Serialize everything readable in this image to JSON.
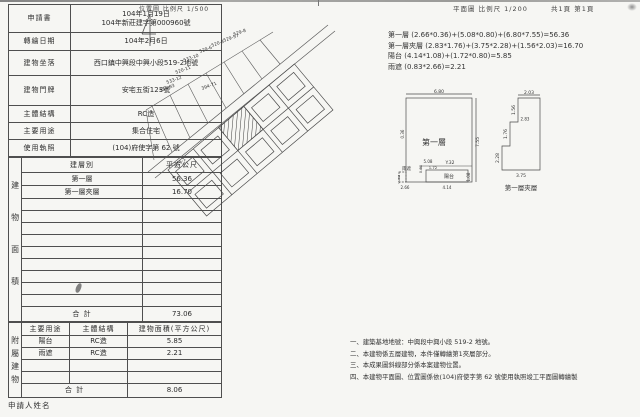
{
  "header": {
    "left_scale": "位置圖 比例尺 1/500",
    "right_scale": "平面圖 比例尺 1/200",
    "page_info": "共1頁 第1頁"
  },
  "info_table": {
    "rows": [
      {
        "label": "申請書",
        "value": "104年1月19日\n104年新莊建字第000960號"
      },
      {
        "label": "轉繪日期",
        "value": "104年2月6日"
      },
      {
        "label": "建物坐落",
        "value": "西口鎮中興段中興小段519-2地號"
      },
      {
        "label": "建物門牌",
        "value": "安宅五街123號"
      },
      {
        "label": "主體結構",
        "value": "RC造"
      },
      {
        "label": "主要用途",
        "value": "集合住宅"
      },
      {
        "label": "使用執照",
        "value": "(104)府使字第 62 號"
      }
    ]
  },
  "area_table": {
    "side_label": "建物面積",
    "header": [
      "建層別",
      "平方公尺"
    ],
    "rows": [
      [
        "第一層",
        "56.36"
      ],
      [
        "第一層夾層",
        "16.70"
      ]
    ],
    "total_label": "合  計",
    "total": "73.06"
  },
  "annex_table": {
    "side_label": "附屬建物",
    "header": [
      "主要用途",
      "主體結構",
      "建物面積(平方公尺)"
    ],
    "rows": [
      [
        "陽台",
        "RC造",
        "5.85"
      ],
      [
        "雨遮",
        "RC造",
        "2.21"
      ]
    ],
    "total_label": "合  計",
    "total": "8.06"
  },
  "applicant_label": "申請人姓名",
  "calc": {
    "lines": [
      "第一層 (2.66*0.36)+(5.08*0.80)+(6.80*7.55)=56.36",
      "第一層夾層 (2.83*1.76)+(3.75*2.28)+(1.56*2.03)=16.70",
      "陽台 (4.14*1.08)+(1.72*0.80)=5.85",
      "雨遮 (0.83*2.66)=2.21"
    ]
  },
  "site_plan": {
    "parcels": [
      "534-93",
      "533-12",
      "520-11",
      "533-10",
      "529-6",
      "520-8",
      "529-57",
      "529-8",
      "394-71"
    ],
    "subject_parcel": "519-1"
  },
  "floor_plan": {
    "title": "第一層",
    "balcony": "陽台",
    "canopy": "雨遮",
    "level_mark": "Y.32",
    "dims": {
      "top": "6.80",
      "right": "7.55",
      "canopy_w": "2.66",
      "canopy_h": "0.83",
      "balcony_w": "4.14",
      "balcony_h": "1.08",
      "strip_w": "5.08",
      "strip_h": "0.80",
      "step_w": "1.72",
      "step_h": "0.36"
    }
  },
  "mezz_plan": {
    "title": "第一層夾層",
    "dims": {
      "top": "2.03",
      "top_h": "1.56",
      "mid_h": "1.76",
      "mid_w": "2.83",
      "bot_h": "2.28",
      "bot_w": "3.75"
    }
  },
  "notes": {
    "lines": [
      "一、建築基地地號：中興段中興小段 519-2 地號。",
      "二、本建物係五層建物，本件僅轉繪第1夾層部分。",
      "三、本成果圖斜線部分係本案建物位置。",
      "四、本建物平面圖、位置圖係依(104)府使字第 62 號使用執照竣工平面圖轉繪製"
    ]
  }
}
